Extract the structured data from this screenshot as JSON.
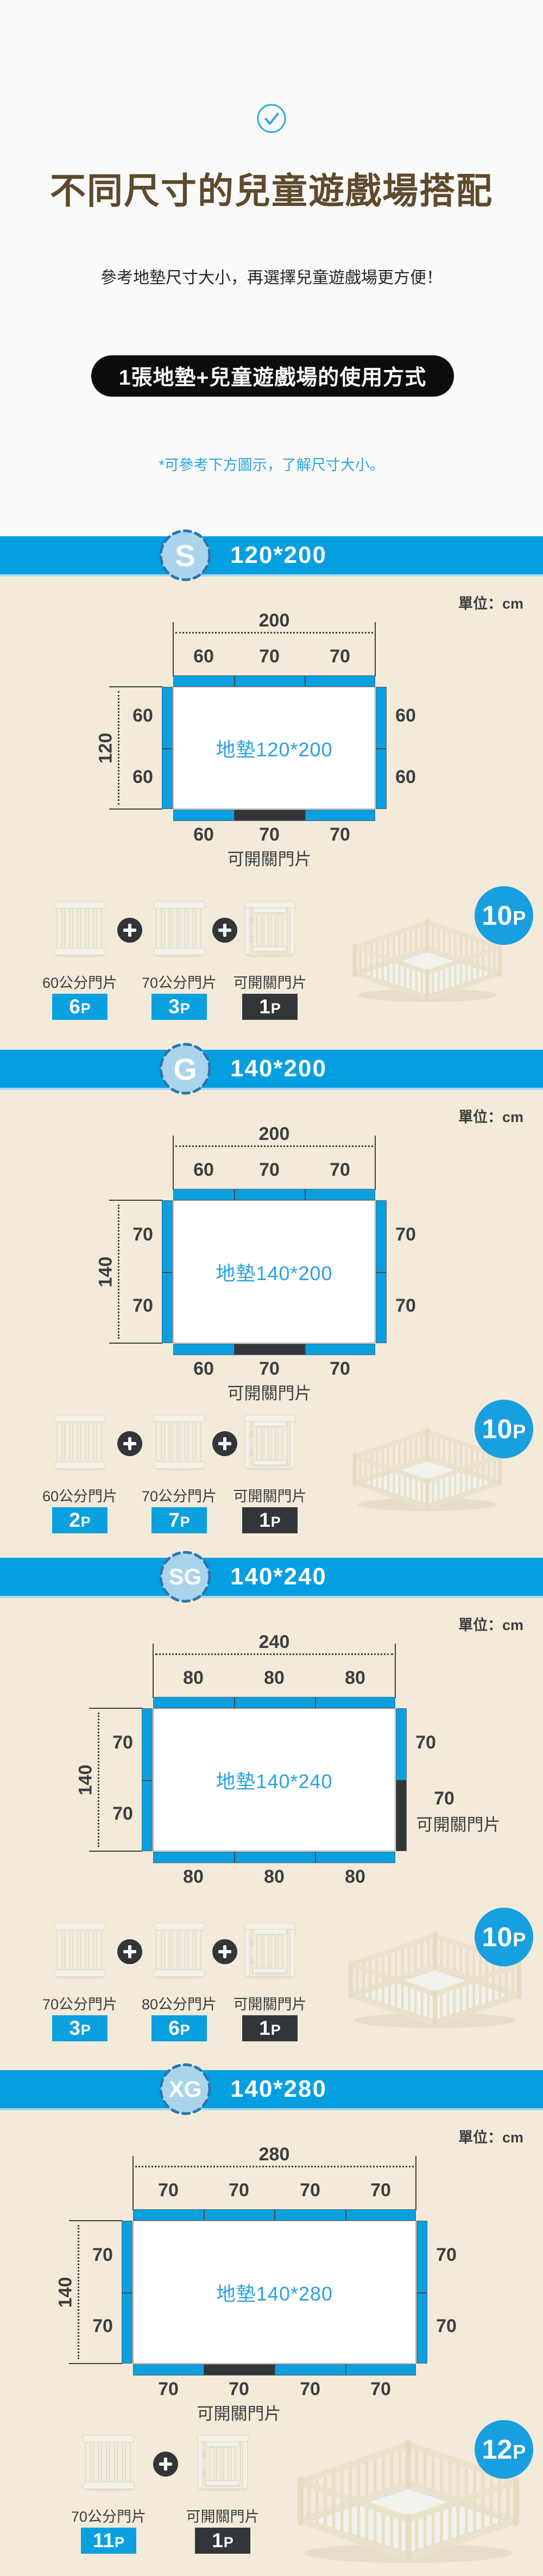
{
  "header": {
    "title": "不同尺寸的兒童遊戲場搭配",
    "subtitle": "參考地墊尺寸大小，再選擇兒童遊戲場更方便！",
    "usage_box": "1張地墊+兒童遊戲場的使用方式",
    "note": "*可參考下方圖示，了解尺寸大小。"
  },
  "misc": {
    "unit_label": "單位：cm"
  },
  "colors": {
    "band_blue": "#049fe0",
    "diagram_blue": "#09a0e0",
    "badge_light_blue": "#a9d4ec",
    "dark": "#333639",
    "beige_bg": "#f4ead9",
    "title_brown": "#5e4a2c",
    "mat_text_blue": "#2aa2e2"
  },
  "sections": [
    {
      "badge": "S",
      "size": "120*200",
      "mat_label": "地墊120*200",
      "top": {
        "total": "200",
        "segments": [
          "60",
          "70",
          "70"
        ]
      },
      "left": {
        "total": "120",
        "labels": [
          "60",
          "60"
        ]
      },
      "right": {
        "labels": [
          "60",
          "60"
        ]
      },
      "bottom": {
        "segments": [
          "60",
          "70",
          "70"
        ],
        "labels": [
          "60",
          "70",
          "70"
        ],
        "door_index": 1,
        "door_label": "可開關門片"
      },
      "parts": [
        {
          "label": "60公分門片",
          "count": "6P",
          "badge_style": "blue",
          "icon": "fence-panel-icon"
        },
        {
          "label": "70公分門片",
          "count": "3P",
          "badge_style": "blue",
          "icon": "fence-panel-icon"
        },
        {
          "label": "可開關門片",
          "count": "1P",
          "badge_style": "dark",
          "icon": "fence-door-icon"
        }
      ],
      "total_count": "10P"
    },
    {
      "badge": "G",
      "size": "140*200",
      "mat_label": "地墊140*200",
      "top": {
        "total": "200",
        "segments": [
          "60",
          "70",
          "70"
        ]
      },
      "left": {
        "total": "140",
        "labels": [
          "70",
          "70"
        ]
      },
      "right": {
        "labels": [
          "70",
          "70"
        ]
      },
      "bottom": {
        "segments": [
          "60",
          "70",
          "70"
        ],
        "labels": [
          "60",
          "70",
          "70"
        ],
        "door_index": 1,
        "door_label": "可開關門片"
      },
      "parts": [
        {
          "label": "60公分門片",
          "count": "2P",
          "badge_style": "blue",
          "icon": "fence-panel-icon"
        },
        {
          "label": "70公分門片",
          "count": "7P",
          "badge_style": "blue",
          "icon": "fence-panel-icon"
        },
        {
          "label": "可開關門片",
          "count": "1P",
          "badge_style": "dark",
          "icon": "fence-door-icon"
        }
      ],
      "total_count": "10P"
    },
    {
      "badge": "SG",
      "size": "140*240",
      "mat_label": "地墊140*240",
      "top": {
        "total": "240",
        "segments": [
          "80",
          "80",
          "80"
        ]
      },
      "left": {
        "total": "140",
        "labels": [
          "70",
          "70"
        ]
      },
      "right": {
        "labels": [
          "70"
        ],
        "door": {
          "size_label": "70",
          "door_label": "可開關門片"
        }
      },
      "bottom": {
        "segments": [
          "80",
          "80",
          "80"
        ],
        "labels": [
          "80",
          "80",
          "80"
        ],
        "door_index": null
      },
      "parts": [
        {
          "label": "70公分門片",
          "count": "3P",
          "badge_style": "blue",
          "icon": "fence-panel-icon"
        },
        {
          "label": "80公分門片",
          "count": "6P",
          "badge_style": "blue",
          "icon": "fence-panel-icon"
        },
        {
          "label": "可開關門片",
          "count": "1P",
          "badge_style": "dark",
          "icon": "fence-door-icon"
        }
      ],
      "total_count": "10P"
    },
    {
      "badge": "XG",
      "size": "140*280",
      "mat_label": "地墊140*280",
      "top": {
        "total": "280",
        "segments": [
          "70",
          "70",
          "70",
          "70"
        ]
      },
      "left": {
        "total": "140",
        "labels": [
          "70",
          "70"
        ]
      },
      "right": {
        "labels": [
          "70",
          "70"
        ]
      },
      "bottom": {
        "segments": [
          "70",
          "70",
          "70",
          "70"
        ],
        "labels": [
          "70",
          "70",
          "70",
          "70"
        ],
        "door_index": 1,
        "door_label": "可開關門片"
      },
      "parts": [
        {
          "label": "70公分門片",
          "count": "11P",
          "badge_style": "blue",
          "icon": "fence-panel-icon"
        },
        {
          "label": "可開關門片",
          "count": "1P",
          "badge_style": "dark",
          "icon": "fence-door-icon"
        }
      ],
      "total_count": "12P"
    }
  ]
}
